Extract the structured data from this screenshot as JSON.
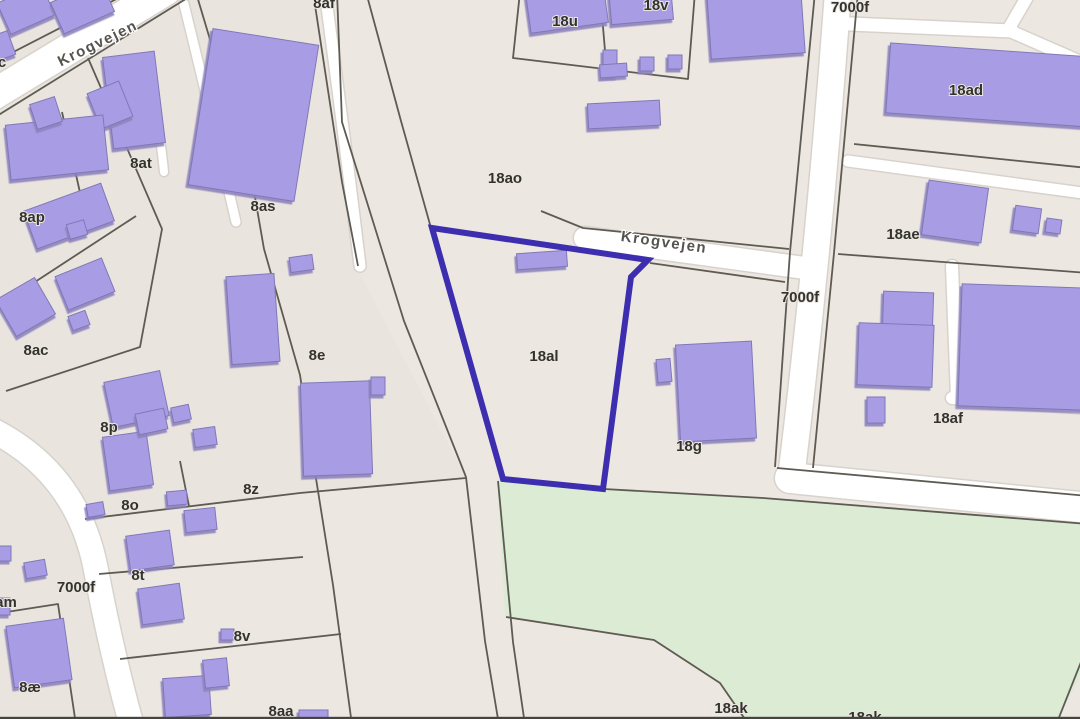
{
  "map": {
    "title": "cadastral-map",
    "colors": {
      "background": "#EDE7E2",
      "background_west": "#E9E3DF",
      "green_area": "#DCEBD4",
      "road_fill": "#FFFFFF",
      "road_casing": "#D8D2CC",
      "boundary_line": "#5E5B52",
      "building_fill": "#A89DE5",
      "building_stroke": "#8077B6",
      "building_shadow": "#8D83BC",
      "selected_outline": "#3D2EB0",
      "bottom_bar": "#45443F"
    },
    "street_labels": [
      {
        "text": "Krogvejen",
        "x": 98,
        "y": 44,
        "rot": -26
      },
      {
        "text": "Krogvejen",
        "x": 664,
        "y": 243,
        "rot": 8
      }
    ],
    "parcel_labels": [
      {
        "text": "c",
        "x": 2,
        "y": 63
      },
      {
        "text": "8af",
        "x": 324,
        "y": 4
      },
      {
        "text": "18u",
        "x": 565,
        "y": 22
      },
      {
        "text": "18v",
        "x": 656,
        "y": 6
      },
      {
        "text": "7000f",
        "x": 850,
        "y": 8
      },
      {
        "text": "18ad",
        "x": 966,
        "y": 91
      },
      {
        "text": "8at",
        "x": 141,
        "y": 164
      },
      {
        "text": "18ao",
        "x": 505,
        "y": 179
      },
      {
        "text": "8as",
        "x": 263,
        "y": 207
      },
      {
        "text": "8ap",
        "x": 32,
        "y": 218
      },
      {
        "text": "18ae",
        "x": 903,
        "y": 235
      },
      {
        "text": "7000f",
        "x": 800,
        "y": 298
      },
      {
        "text": "8ac",
        "x": 36,
        "y": 351
      },
      {
        "text": "8e",
        "x": 317,
        "y": 356
      },
      {
        "text": "18al",
        "x": 544,
        "y": 357
      },
      {
        "text": "18af",
        "x": 948,
        "y": 419
      },
      {
        "text": "8p",
        "x": 109,
        "y": 428
      },
      {
        "text": "18g",
        "x": 689,
        "y": 447
      },
      {
        "text": "8z",
        "x": 251,
        "y": 490
      },
      {
        "text": "8o",
        "x": 130,
        "y": 506
      },
      {
        "text": "8t",
        "x": 138,
        "y": 576
      },
      {
        "text": "7000f",
        "x": 76,
        "y": 588
      },
      {
        "text": "am",
        "x": 6,
        "y": 603
      },
      {
        "text": "8v",
        "x": 242,
        "y": 637
      },
      {
        "text": "8æ",
        "x": 30,
        "y": 688
      },
      {
        "text": "8aa",
        "x": 281,
        "y": 712
      },
      {
        "text": "18ak",
        "x": 731,
        "y": 709
      },
      {
        "text": "18ak",
        "x": 865,
        "y": 718
      }
    ],
    "green_areas": [
      "497,479 604,489 763,498 1088,524 1088,661 1055,725 748,725 719,682 653,639 505,616"
    ],
    "west_tint": "0,0 313,0 358,270 466,478 300,493 85,519 95,565 133,725 0,725",
    "roads": [
      {
        "d": "M 166 -10 L -12 98",
        "w": 30
      },
      {
        "d": "M 184 4 Q 210 110 236 222",
        "w": 9
      },
      {
        "d": "M 325 -8 Q 345 140 360 266",
        "w": 11
      },
      {
        "d": "M 150 82 Q 160 130 164 172",
        "w": 8
      },
      {
        "d": "M 585 238 L 812 269",
        "w": 22
      },
      {
        "d": "M 838 -8 Q 820 240 792 470",
        "w": 26
      },
      {
        "d": "M 790 478 Q 930 492 1090 508",
        "w": 30
      },
      {
        "d": "M 850 24 L 1012 31",
        "w": 13
      },
      {
        "d": "M 1008 30 L 1030 -8",
        "w": 12
      },
      {
        "d": "M 1010 31 L 1090 66",
        "w": 12
      },
      {
        "d": "M 848 161 L 1090 194",
        "w": 11
      },
      {
        "d": "M 952 266 L 957 398",
        "w": 12
      },
      {
        "d": "M 952 398 L 1090 408",
        "w": 12
      },
      {
        "d": "M -12 428 Q 75 470 95 565 Q 112 655 133 730",
        "w": 24
      }
    ],
    "boundaries": [
      "130,-8 -8,63",
      "197,-8 -8,119",
      "88,58 162,229 140,347 6,391",
      "136,216 -8,310",
      "197,-4 252,180 264,249",
      "264,249 300,375 314,466 333,585 352,725",
      "313,-8 342,182 358,266",
      "337,-8 342,122 404,321 466,477",
      "366,-8 401,121 431,228",
      "466,477 485,641 499,725",
      "498,481 513,642 525,725",
      "85,519 300,493 466,478",
      "180,461 189,506",
      "99,574 303,557",
      "120,659 341,634",
      "0,613 58,604 76,725",
      "62,112 83,206",
      "520,-8 513,58 688,79 695,-8",
      "600,-8 607,74",
      "541,211 583,228 789,249",
      "650,263 785,282",
      "815,-8 790,252 775,467",
      "858,-8 834,253 813,468",
      "838,254 1088,273",
      "854,144 1088,168",
      "604,489 763,498",
      "763,498 1088,524",
      "777,468 1088,496",
      "506,617 654,640 720,683 749,725",
      "1081,662 1056,725"
    ],
    "buildings": [
      [
        2,
        -8,
        48,
        34,
        -24
      ],
      [
        55,
        -10,
        55,
        34,
        -24
      ],
      [
        108,
        54,
        52,
        92,
        -7
      ],
      [
        93,
        86,
        34,
        38,
        -22
      ],
      [
        200,
        36,
        107,
        158,
        9
      ],
      [
        8,
        120,
        98,
        55,
        -6
      ],
      [
        33,
        100,
        26,
        26,
        -18
      ],
      [
        28,
        196,
        82,
        40,
        -20
      ],
      [
        68,
        222,
        18,
        15,
        -16
      ],
      [
        3,
        286,
        45,
        42,
        -30
      ],
      [
        60,
        266,
        50,
        36,
        -22
      ],
      [
        70,
        313,
        18,
        15,
        -20
      ],
      [
        108,
        376,
        57,
        46,
        -12
      ],
      [
        106,
        434,
        44,
        54,
        -8
      ],
      [
        229,
        275,
        48,
        88,
        -4
      ],
      [
        290,
        256,
        23,
        15,
        -8
      ],
      [
        302,
        382,
        69,
        93,
        -2
      ],
      [
        371,
        377,
        14,
        18,
        0
      ],
      [
        137,
        411,
        29,
        21,
        -12
      ],
      [
        172,
        406,
        18,
        15,
        -12
      ],
      [
        194,
        428,
        22,
        18,
        -8
      ],
      [
        185,
        509,
        31,
        22,
        -6
      ],
      [
        128,
        533,
        44,
        35,
        -8
      ],
      [
        87,
        503,
        17,
        13,
        -10
      ],
      [
        167,
        491,
        20,
        14,
        -5
      ],
      [
        140,
        586,
        42,
        36,
        -8
      ],
      [
        10,
        622,
        58,
        62,
        -8
      ],
      [
        -6,
        598,
        16,
        17,
        0
      ],
      [
        -5,
        546,
        16,
        15,
        0
      ],
      [
        25,
        561,
        21,
        16,
        -10
      ],
      [
        221,
        629,
        13,
        11,
        0
      ],
      [
        164,
        677,
        46,
        39,
        -4
      ],
      [
        204,
        659,
        24,
        28,
        -6
      ],
      [
        299,
        710,
        29,
        10,
        0
      ],
      [
        -6,
        33,
        18,
        25,
        -20
      ],
      [
        528,
        -12,
        78,
        40,
        -8
      ],
      [
        610,
        -14,
        62,
        36,
        -5
      ],
      [
        603,
        50,
        14,
        27,
        0
      ],
      [
        640,
        57,
        14,
        14,
        0
      ],
      [
        668,
        55,
        14,
        14,
        0
      ],
      [
        600,
        64,
        27,
        13,
        -4
      ],
      [
        588,
        102,
        72,
        25,
        -3
      ],
      [
        709,
        -10,
        94,
        66,
        -4
      ],
      [
        888,
        50,
        205,
        70,
        4
      ],
      [
        925,
        184,
        60,
        55,
        8
      ],
      [
        1014,
        207,
        26,
        25,
        8
      ],
      [
        1046,
        219,
        15,
        14,
        8
      ],
      [
        883,
        292,
        50,
        39,
        2
      ],
      [
        858,
        324,
        75,
        62,
        2
      ],
      [
        867,
        397,
        18,
        26,
        0
      ],
      [
        960,
        286,
        128,
        122,
        2
      ],
      [
        678,
        343,
        76,
        97,
        -3
      ],
      [
        657,
        359,
        14,
        23,
        -5
      ],
      [
        517,
        252,
        50,
        16,
        -4
      ]
    ],
    "selected_parcel": {
      "label": "18al",
      "points": "432,228 648,260 631,277 603,489 503,479",
      "stroke_width": 6
    }
  }
}
